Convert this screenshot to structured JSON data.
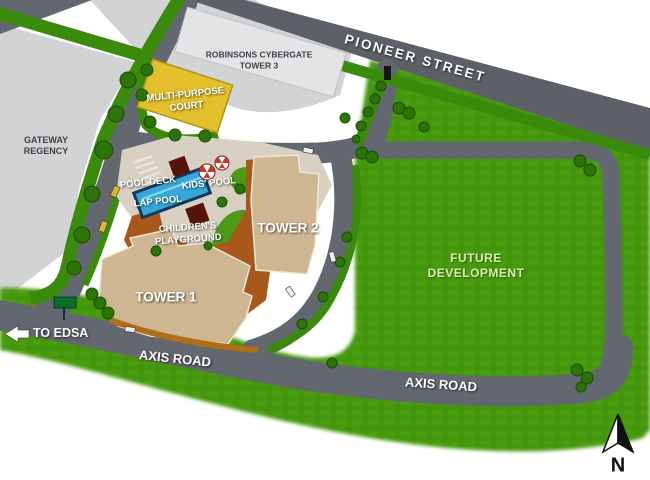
{
  "labels": {
    "pioneer": "PIONEER STREET",
    "robinsons1": "ROBINSONS CYBERGATE",
    "robinsons2": "TOWER 3",
    "gateway1": "GATEWAY",
    "gateway2": "REGENCY",
    "court1": "MULTI-PURPOSE",
    "court2": "COURT",
    "pool_deck": "POOL DECK",
    "kids_pool": "KIDS' POOL",
    "lap_pool": "LAP POOL",
    "playground1": "CHILDREN'S",
    "playground2": "PLAYGROUND",
    "tower1": "TOWER 1",
    "tower2": "TOWER 2",
    "future1": "FUTURE",
    "future2": "DEVELOPMENT",
    "axis": "AXIS ROAD",
    "to_edsa": "TO EDSA",
    "north": "N"
  },
  "colors": {
    "road": "#63676f",
    "pioneer": "#5d6167",
    "grass": "#449708",
    "grassLight": "#5fb91e",
    "grassDark": "#3a7f06",
    "hedge": "#3a8a0c",
    "hedgeDark": "#2c7407",
    "ground": "#d2d3d5",
    "buildingLight": "#e3e4e6",
    "court": "#e2bf2b",
    "tower": "#cdb691",
    "towerEdge": "#f0e7d2",
    "podium": "#a8581b",
    "paving": "#d8d0c3",
    "pool": "#35a8d8",
    "poolDark": "#14375e",
    "cabana": "#571209",
    "autumnHedge": "#b06f16",
    "signGreen": "#0a6e2a",
    "carYellow": "#d8b62a",
    "carWhite": "#eeeeee",
    "umbrellaRed": "#c0392b"
  }
}
